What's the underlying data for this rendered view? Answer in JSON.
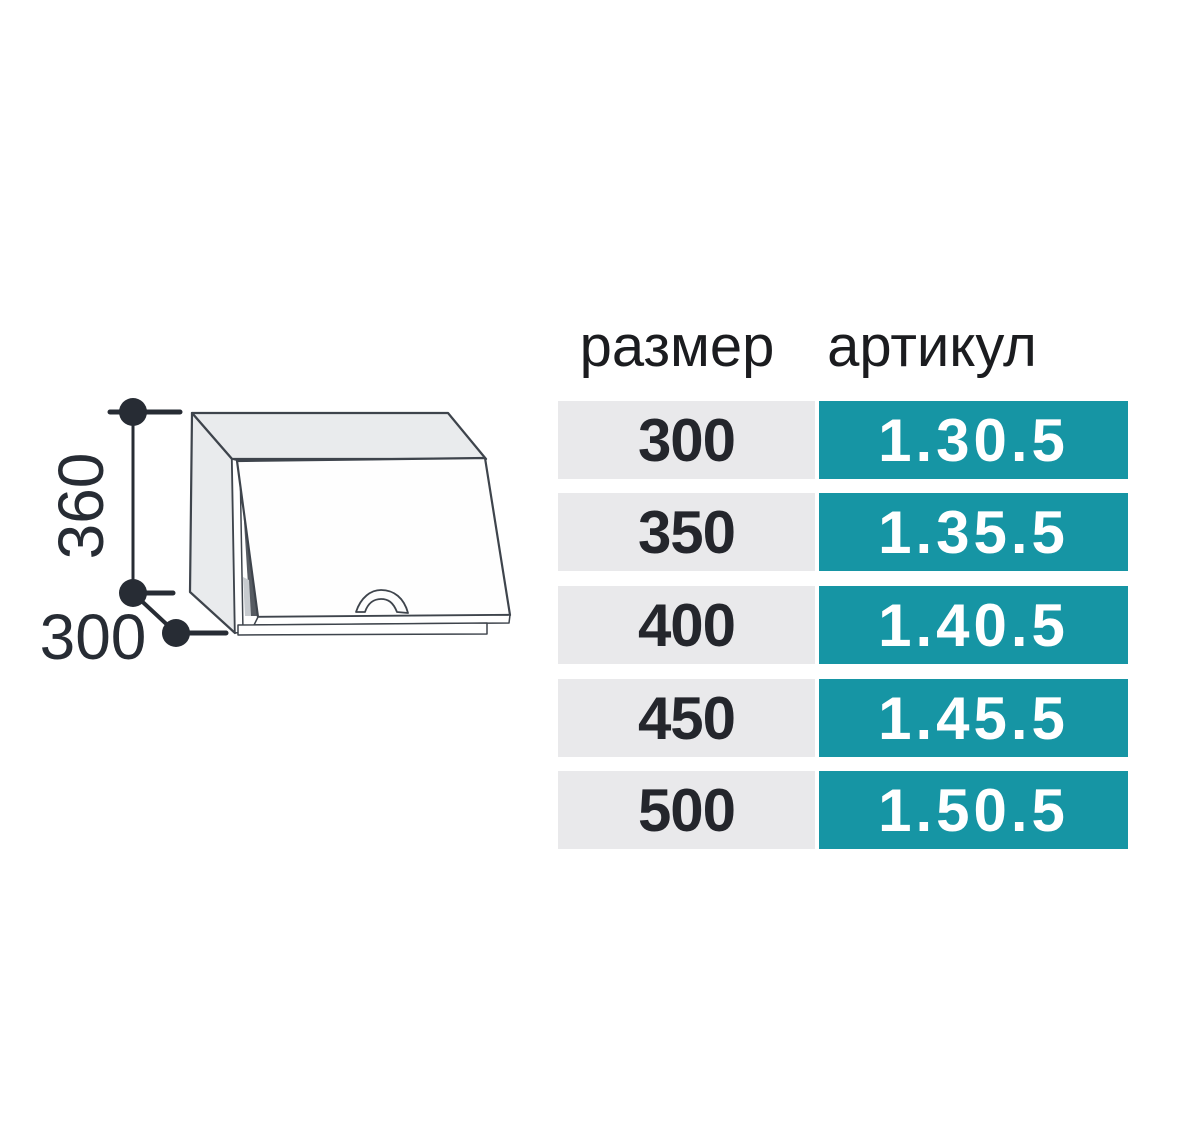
{
  "diagram": {
    "height_label": "360",
    "depth_label": "300"
  },
  "table": {
    "headers": {
      "size": "размер",
      "article": "артикул"
    },
    "rows": [
      {
        "size": "300",
        "article": "1.30.5"
      },
      {
        "size": "350",
        "article": "1.35.5"
      },
      {
        "size": "400",
        "article": "1.40.5"
      },
      {
        "size": "450",
        "article": "1.45.5"
      },
      {
        "size": "500",
        "article": "1.50.5"
      }
    ]
  },
  "colors": {
    "accent_teal": "#1695a4",
    "row_gray": "#e9e9eb",
    "text_dark": "#24262c",
    "outline": "#3e444c",
    "panel_fill": "#e9ebed",
    "dimension": "#272c34"
  }
}
